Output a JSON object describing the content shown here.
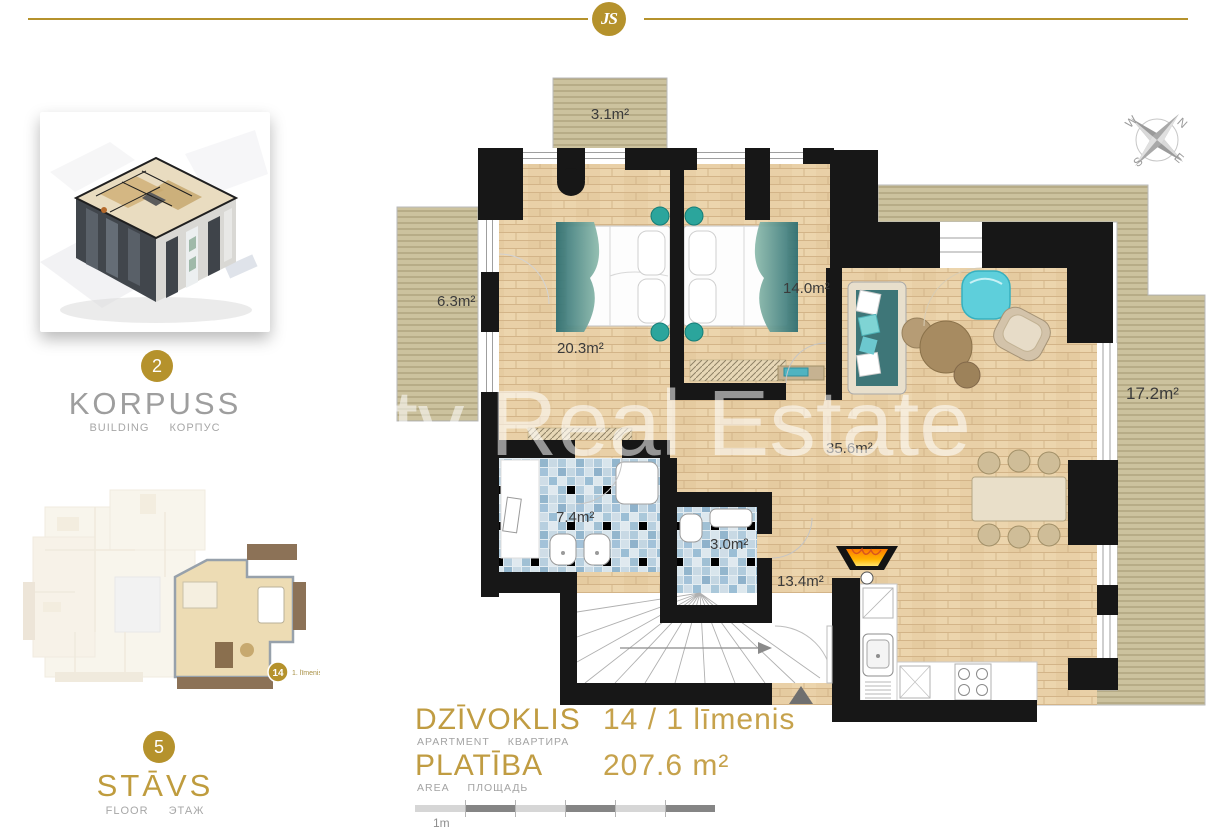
{
  "colors": {
    "gold": "#b5922c",
    "gold_text": "#c09c42",
    "wall": "#171717",
    "wood": "#e8cfa6",
    "tile_blue": "#a3c2d9",
    "deck": "#ccc29e"
  },
  "header": {
    "logo_text": "JS"
  },
  "sidebar": {
    "building": {
      "badge": "2",
      "title": "KORPUSS",
      "subtitle_en": "BUILDING",
      "subtitle_ru": "КОРПУС"
    },
    "floor": {
      "badge": "5",
      "title": "STĀVS",
      "subtitle_en": "FLOOR",
      "subtitle_ru": "ЭТАЖ"
    },
    "minimap": {
      "badge": "14",
      "note": "1. līmenis"
    }
  },
  "plan": {
    "watermark": "tv Real Estate",
    "compass": {
      "n": "N",
      "w": "W",
      "s": "S",
      "e": "E"
    },
    "labels": {
      "balcony_top": "3.1m²",
      "balcony_left": "6.3m²",
      "bedroom1": "20.3m²",
      "bedroom2": "14.0m²",
      "terrace": "17.2m²",
      "living": "35.6m²",
      "bathroom": "7.4m²",
      "wc": "3.0m²",
      "hallway": "13.4m²"
    }
  },
  "footer": {
    "apartment": {
      "label": "DZĪVOKLIS",
      "sub_en": "APARTMENT",
      "sub_ru": "КВАРТИРА",
      "value": "14 / 1 līmenis"
    },
    "area": {
      "label": "PLATĪBA",
      "sub_en": "AREA",
      "sub_ru": "ПЛОЩАДЬ",
      "value": "207.6 m²"
    },
    "scale_label": "1m"
  }
}
